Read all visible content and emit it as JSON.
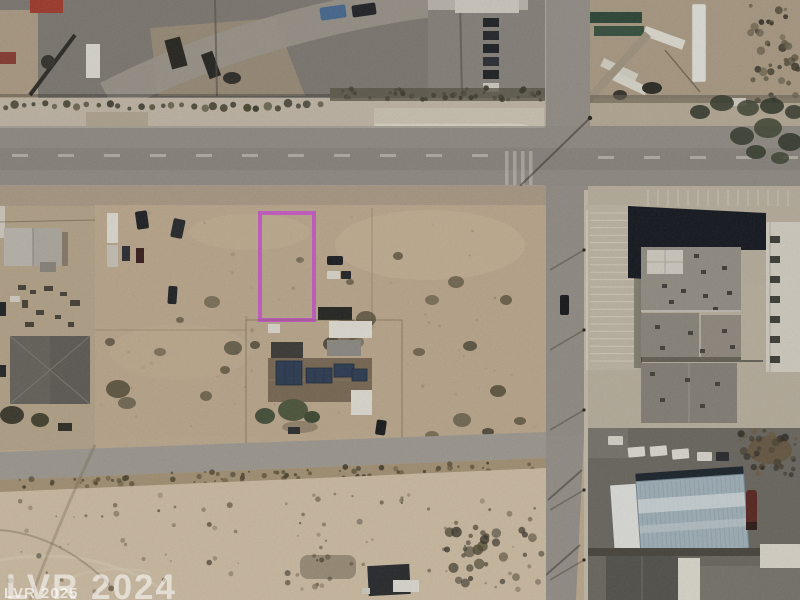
{
  "watermarks": {
    "primary": "LVR 2024",
    "secondary": "LVR 2025"
  },
  "colors": {
    "parcel_outline": "#d05fce",
    "watermark": "#ffffff",
    "desert_ground": "#c7b295",
    "road_asphalt": "#97918a",
    "warehouse_roof": "#a8b8c2",
    "commercial_roof_dark": "#12161e"
  }
}
